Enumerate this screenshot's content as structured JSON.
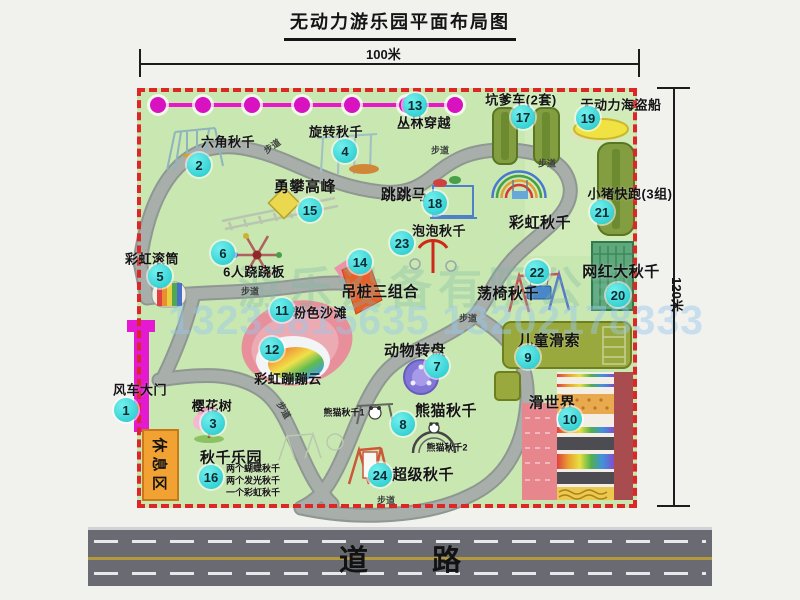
{
  "title": "无动力游乐园平面布局图",
  "dimensions": {
    "width": "100米",
    "height": "120米"
  },
  "watermark": {
    "company": "游乐设备有限公司",
    "phone": "13233815635 13202178333"
  },
  "road_label": "道路",
  "path_label": "步道",
  "rest_area_label": "休息区",
  "extra_labels": {
    "rainbow_swing": "彩虹秋千",
    "panda_swing_1": "熊猫秋千1",
    "panda_swing_2": "熊猫秋千2",
    "swing_park_items": [
      "两个蝴蝶秋千",
      "两个发光秋千",
      "一个彩虹秋千"
    ]
  },
  "colors": {
    "map_green": "#c9e7b1",
    "border_red": "#dd2626",
    "badge_cyan": "#1fc6cc",
    "gate_magenta": "#e41ad2",
    "zipline_olive": "#9aa93d",
    "cart_green": "#839e41",
    "road_gray": "#6a6a73",
    "rest_orange": "#f1a233",
    "beach_pink": "#e7909b"
  },
  "attractions": [
    {
      "num": "1",
      "name": "风车大门"
    },
    {
      "num": "2",
      "name": "六角秋千"
    },
    {
      "num": "3",
      "name": "樱花树"
    },
    {
      "num": "4",
      "name": "旋转秋千"
    },
    {
      "num": "5",
      "name": "彩虹滚筒"
    },
    {
      "num": "6",
      "name": "6人跷跷板"
    },
    {
      "num": "7",
      "name": "动物转盘"
    },
    {
      "num": "8",
      "name": "熊猫秋千"
    },
    {
      "num": "9",
      "name": "儿童滑索"
    },
    {
      "num": "10",
      "name": "滑世界"
    },
    {
      "num": "11",
      "name": "粉色沙滩"
    },
    {
      "num": "12",
      "name": "彩虹蹦蹦云"
    },
    {
      "num": "13",
      "name": "丛林穿越"
    },
    {
      "num": "14",
      "name": "吊桩三组合"
    },
    {
      "num": "15",
      "name": "勇攀高峰"
    },
    {
      "num": "16",
      "name": "秋千乐园"
    },
    {
      "num": "17",
      "name": "坑爹车(2套)"
    },
    {
      "num": "18",
      "name": "跳跳马"
    },
    {
      "num": "19",
      "name": "无动力海盗船"
    },
    {
      "num": "20",
      "name": "网红大秋千"
    },
    {
      "num": "21",
      "name": "小猪快跑(3组)"
    },
    {
      "num": "22",
      "name": "荡椅秋千"
    },
    {
      "num": "23",
      "name": "泡泡秋千"
    },
    {
      "num": "24",
      "name": "超级秋千"
    }
  ]
}
